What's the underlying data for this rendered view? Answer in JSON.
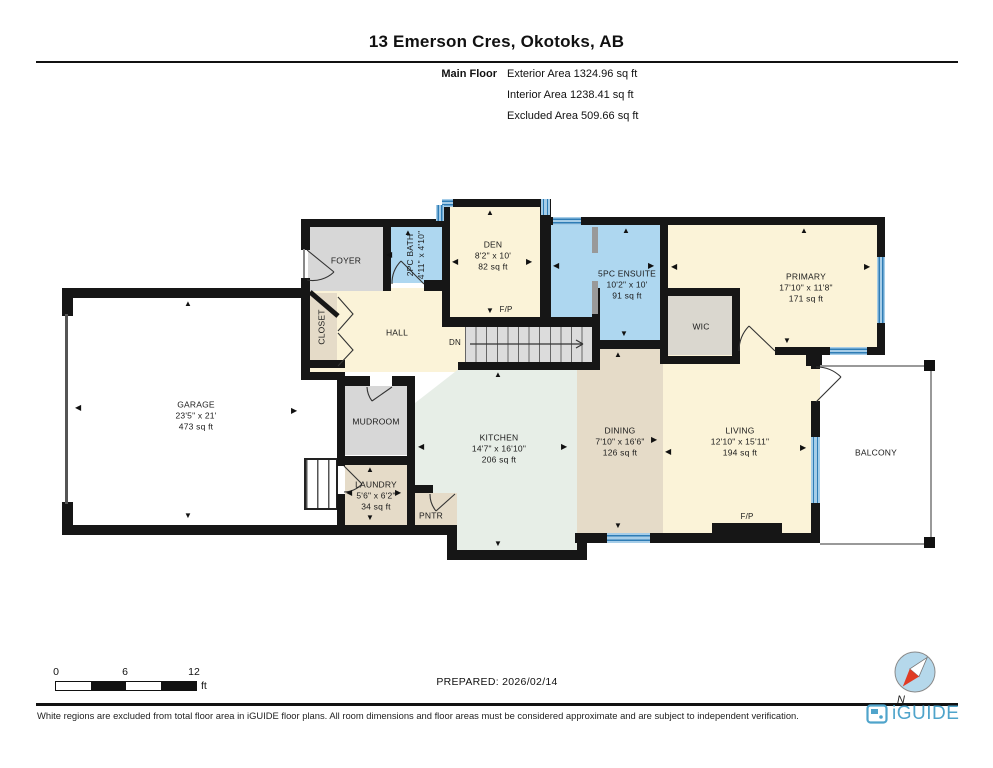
{
  "header": {
    "title": "13 Emerson Cres, Okotoks, AB",
    "floor_label": "Main Floor",
    "stats": [
      "Exterior Area 1324.96 sq ft",
      "Interior Area 1238.41 sq ft",
      "Excluded Area 509.66 sq ft"
    ]
  },
  "rooms": {
    "garage": {
      "name": "GARAGE",
      "dims": "23'5\" x 21'",
      "area": "473 sq ft"
    },
    "foyer": {
      "name": "FOYER"
    },
    "closet": {
      "name": "CLOSET"
    },
    "hall": {
      "name": "HALL"
    },
    "bath": {
      "name": "2PC BATH",
      "dims": "4'11\" x 4'10\""
    },
    "den": {
      "name": "DEN",
      "dims": "8'2\" x 10'",
      "area": "82 sq ft"
    },
    "ensuite": {
      "name": "5PC ENSUITE",
      "dims": "10'2\" x 10'",
      "area": "91 sq ft"
    },
    "primary": {
      "name": "PRIMARY",
      "dims": "17'10\" x 11'8\"",
      "area": "171 sq ft"
    },
    "wic": {
      "name": "WIC"
    },
    "mudroom": {
      "name": "MUDROOM"
    },
    "laundry": {
      "name": "LAUNDRY",
      "dims": "5'6\" x 6'2\"",
      "area": "34 sq ft"
    },
    "kitchen": {
      "name": "KITCHEN",
      "dims": "14'7\" x 16'10\"",
      "area": "206 sq ft"
    },
    "pntr": {
      "name": "PNTR"
    },
    "dining": {
      "name": "DINING",
      "dims": "7'10\" x 16'6\"",
      "area": "126 sq ft"
    },
    "living": {
      "name": "LIVING",
      "dims": "12'10\" x 15'11\"",
      "area": "194 sq ft"
    },
    "balcony": {
      "name": "BALCONY"
    }
  },
  "labels": {
    "dn": "DN",
    "fp": "F/P",
    "north": "N",
    "ft": "ft"
  },
  "scale": {
    "ticks": [
      "0",
      "6",
      "12"
    ]
  },
  "glyphs": {
    "up": "▲",
    "down": "▼",
    "left": "◀",
    "right": "▶"
  },
  "footer": {
    "prepared": "PREPARED: 2026/02/14",
    "disclaimer": "White regions are excluded from total floor area in iGUIDE floor plans. All room dimensions and floor areas must be considered approximate and are subject to independent verification.",
    "brand": "iGUIDE"
  },
  "colors": {
    "wall": "#161616",
    "room_cream": "#FBF3D8",
    "room_blue": "#AED7F0",
    "room_gray": "#D7D7D7",
    "room_tan": "#E5DBC8",
    "room_mint": "#E7EEE7",
    "window_blue": "#2E7CB5",
    "brand_blue": "#4FA4CB",
    "compass_blue": "#B5D8EB",
    "needle_red": "#E03B24"
  }
}
